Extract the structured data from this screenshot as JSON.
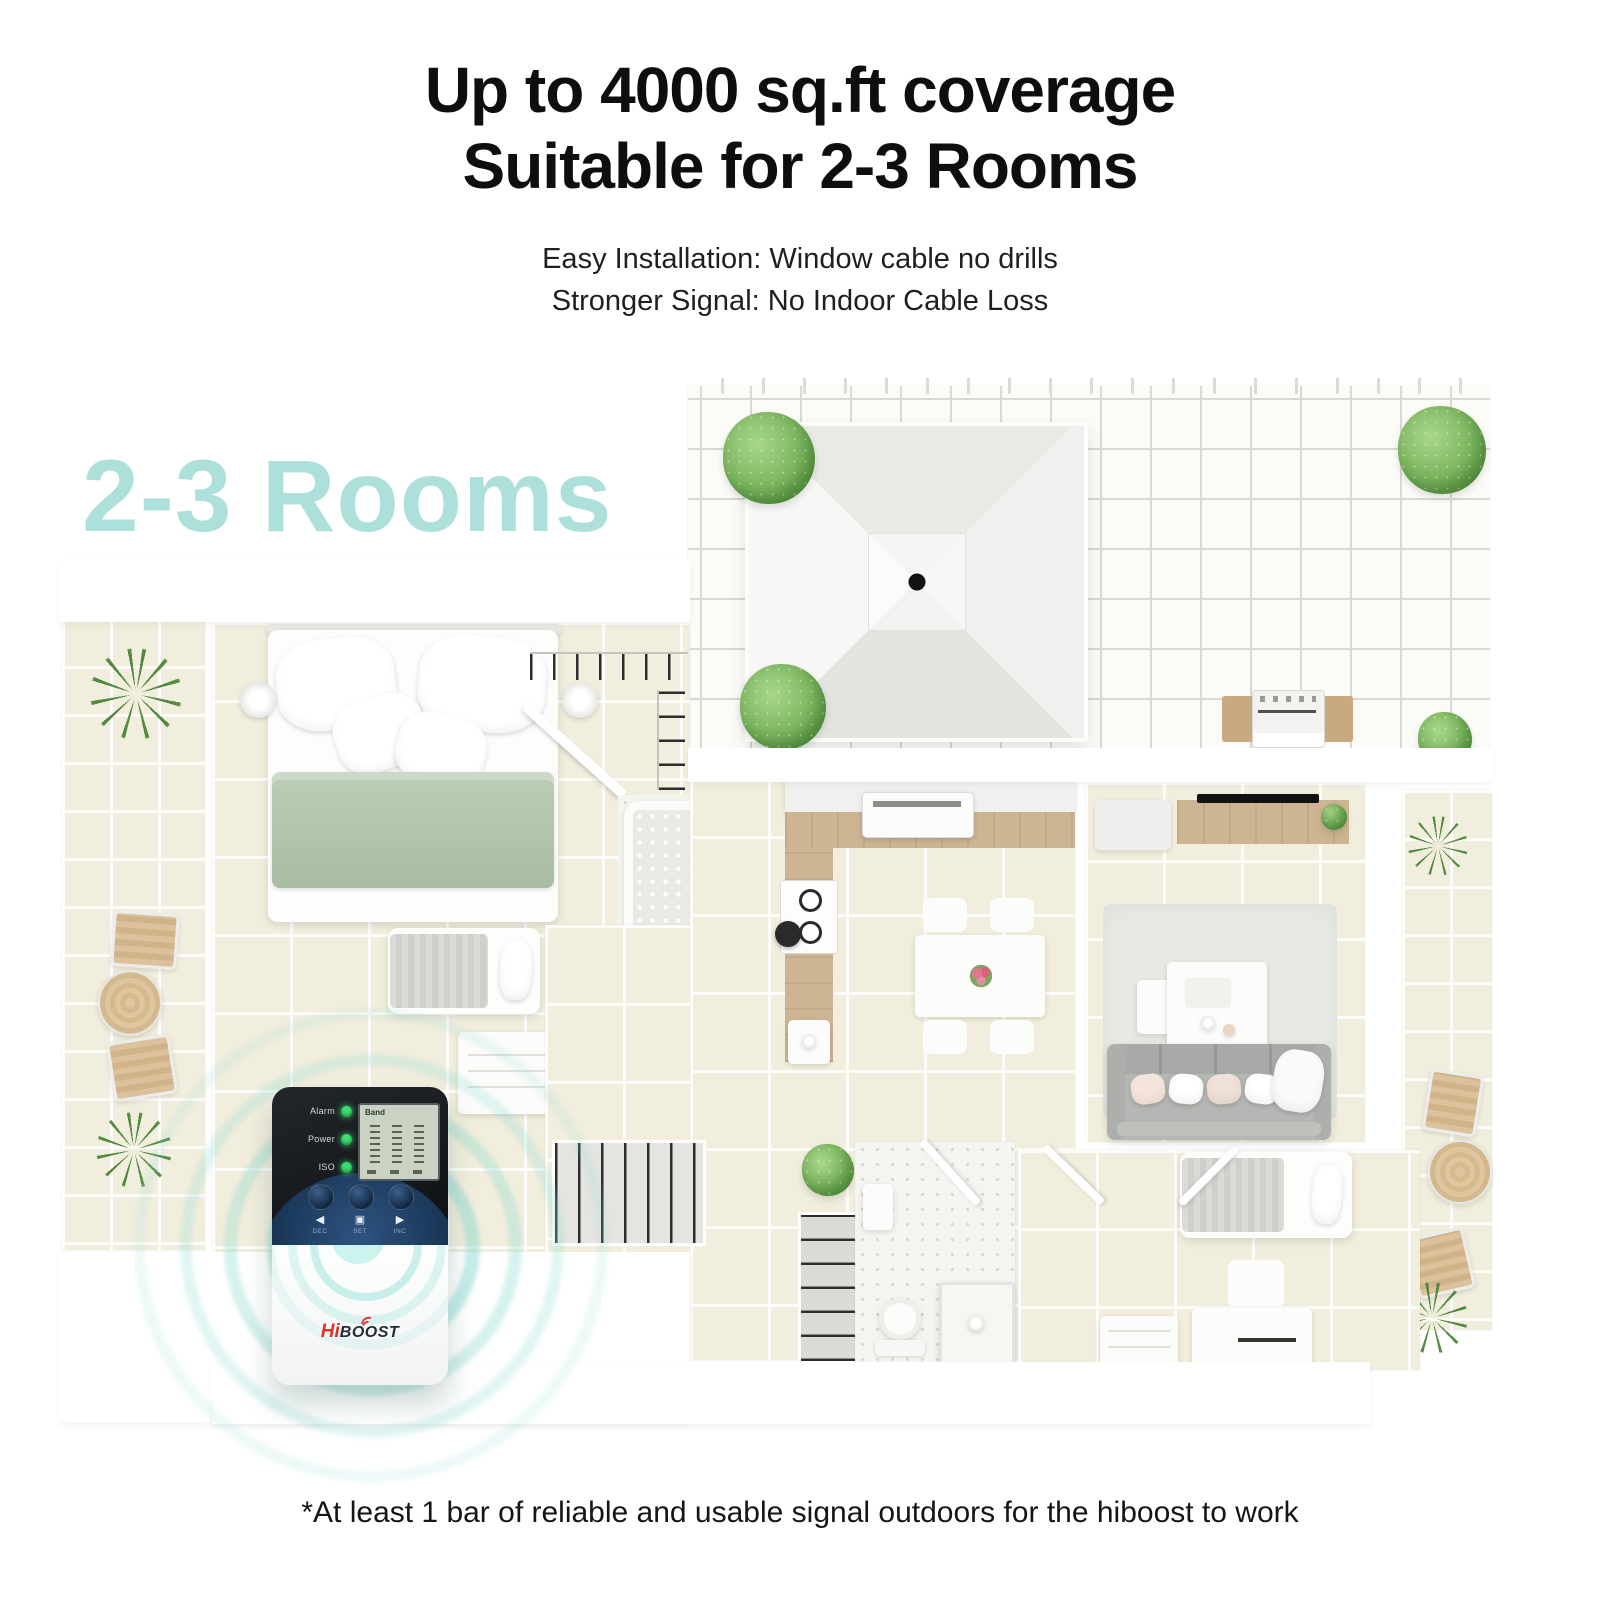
{
  "header": {
    "title_line1": "Up to 4000 sq.ft coverage",
    "title_line2": "Suitable for 2-3 Rooms",
    "subtitle_line1": "Easy Installation: Window cable no drills",
    "subtitle_line2": "Stronger Signal: No Indoor Cable Loss"
  },
  "plan": {
    "overlay_label": "2-3 Rooms"
  },
  "device": {
    "leds": [
      "Alarm",
      "Power",
      "ISO"
    ],
    "lcd_label": "Band",
    "button_glyphs": [
      "◀",
      "▣",
      "▶"
    ],
    "buttons": [
      "DEC",
      "SET",
      "INC"
    ],
    "logo_hi": "Hi",
    "logo_boost": "BOOST"
  },
  "footer": {
    "note": "*At least 1 bar of reliable and usable signal outdoors for the hiboost to work"
  },
  "colors": {
    "accent_teal": "#ade0da",
    "ring_teal": "#8ddbd3",
    "led_green": "#3ae06e",
    "logo_red": "#e03228",
    "title_black": "#0e0e0e"
  }
}
